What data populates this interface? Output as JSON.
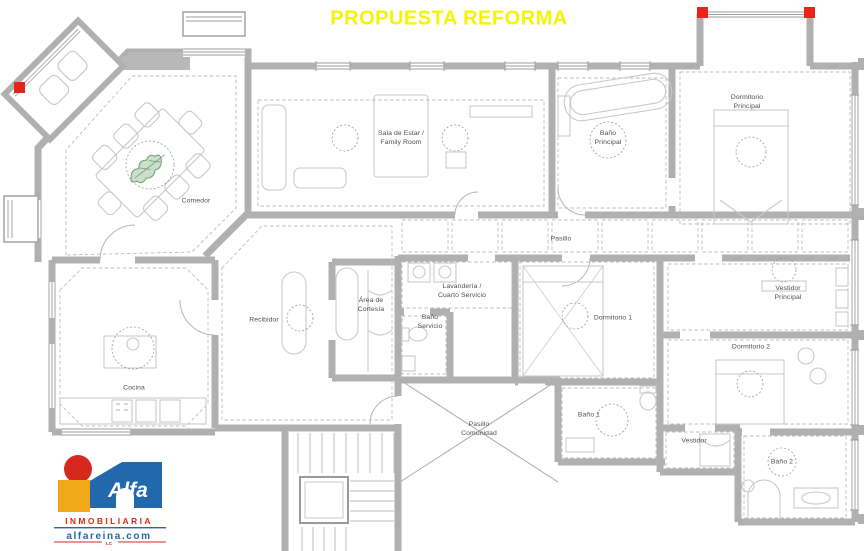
{
  "title": "PROPUESTA REFORMA",
  "colors": {
    "title_yellow": "#F5F401",
    "wall_gray": "#B0B0B0",
    "column_marker_red": "#E8231A",
    "plant_green": "#6F9E6F",
    "logo_blue": "#2268AC",
    "logo_red": "#D5281E",
    "logo_yellow": "#F0A818"
  },
  "rooms": {
    "comedor": {
      "label": "Comedor"
    },
    "sala_estar": {
      "label": "Sala de Estar /\nFamily Room"
    },
    "bano_principal": {
      "label": "Baño\nPrincipal"
    },
    "dormitorio_principal": {
      "label": "Dormitorio\nPrincipal"
    },
    "pasillo": {
      "label": "Pasillo"
    },
    "recibidor": {
      "label": "Recibidor"
    },
    "area_cortesia": {
      "label": "Área de\nCortesía"
    },
    "lavanderia": {
      "label": "Lavandería /\nCuarto Servicio"
    },
    "bano_servicio": {
      "label": "Baño\nServicio"
    },
    "dormitorio_1": {
      "label": "Dormitorio 1"
    },
    "vestidor_principal": {
      "label": "Vestidor\nPrincipal"
    },
    "dormitorio_2": {
      "label": "Dormitorio 2"
    },
    "cocina": {
      "label": "Cocina"
    },
    "bano_1": {
      "label": "Baño 1"
    },
    "vestidor": {
      "label": "Vestidor"
    },
    "bano_2": {
      "label": "Baño 2"
    },
    "pasillo_comunidad": {
      "label": "Pasillo\nComunidad"
    }
  },
  "logo": {
    "brand": "Alfa",
    "line1": "INMOBILIARIA",
    "line2": "alfareina.com",
    "line3": "LC"
  }
}
